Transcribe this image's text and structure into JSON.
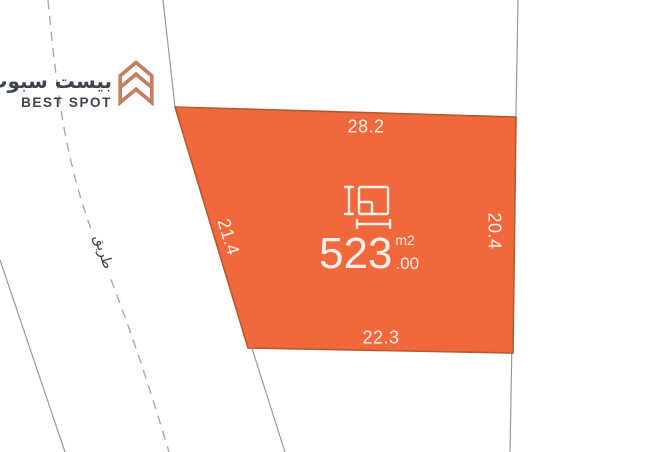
{
  "brand": {
    "name_arabic": "بيست سبوت",
    "name_english": "BEST SPOT"
  },
  "road": {
    "label_arabic": "طريق"
  },
  "plot": {
    "area": {
      "value": "523",
      "decimal": ".00",
      "unit": "m2"
    },
    "dimensions": {
      "top": "28.2",
      "left": "21.4",
      "right": "20.4",
      "bottom": "22.3"
    }
  },
  "colors": {
    "plot_fill": "#F1683C",
    "plot_border": "#B45A2E",
    "boundary_line": "#999999",
    "road_dash": "#A9A9A9",
    "dimension_text": "#FBEFE7",
    "logo_accent": "#C87B5E",
    "logo_text": "#3D4450",
    "road_text": "#3A4048"
  }
}
